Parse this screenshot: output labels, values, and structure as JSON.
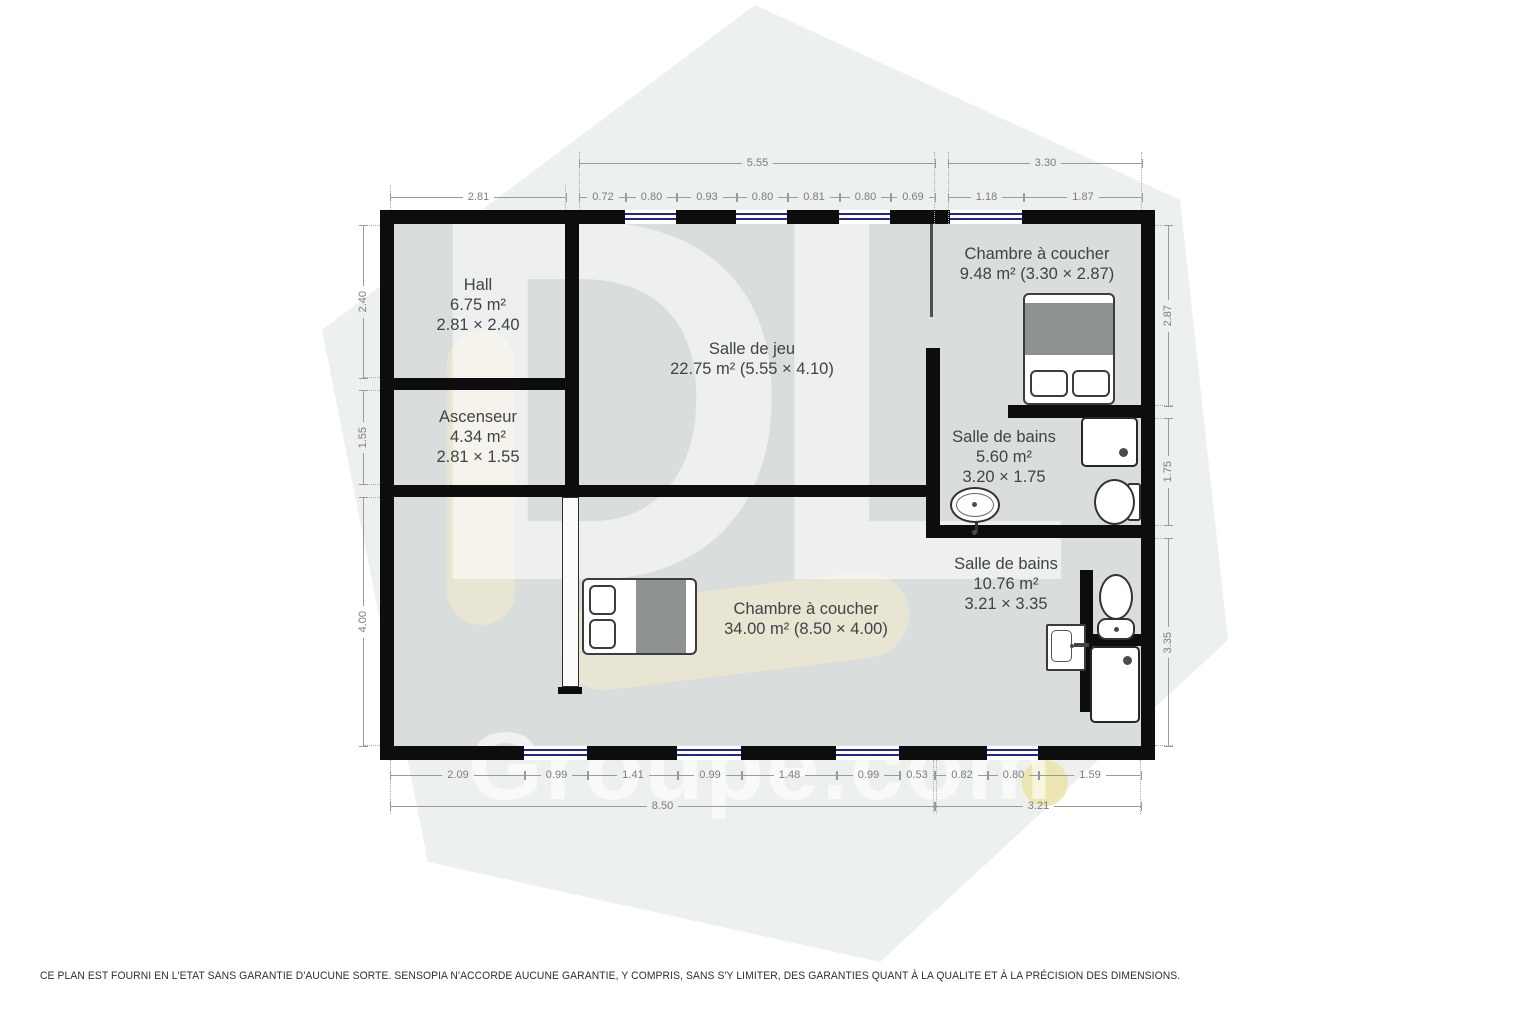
{
  "watermark": {
    "logo": "DL",
    "brand": "Groupe.com"
  },
  "palette": {
    "wall": "#0d0d0d",
    "floor": "#d9dddc",
    "hexagon": "#edf1ed",
    "window_glass": "#24249a",
    "dim_line": "#9a9a9a",
    "dim_text": "#7c7c7c",
    "room_text": "#3e4347",
    "watermark_accent": "#efeacd"
  },
  "rooms": {
    "hall": {
      "name": "Hall",
      "area": "6.75 m²",
      "size": "2.81 × 2.40"
    },
    "ascenseur": {
      "name": "Ascenseur",
      "area": "4.34 m²",
      "size": "2.81 × 1.55"
    },
    "salle_de_jeu": {
      "name": "Salle de jeu",
      "details": "22.75 m² (5.55 × 4.10)"
    },
    "chambre_nord": {
      "name": "Chambre à coucher",
      "details": "9.48 m² (3.30 × 2.87)"
    },
    "sdb_nord": {
      "name": "Salle de bains",
      "area": "5.60 m²",
      "size": "3.20 × 1.75"
    },
    "sdb_sud": {
      "name": "Salle de bains",
      "area": "10.76 m²",
      "size": "3.21 × 3.35"
    },
    "chambre_sud": {
      "name": "Chambre à coucher",
      "details": "34.00 m² (8.50 × 4.00)"
    }
  },
  "dimensions": [
    {
      "label": "5.55",
      "orient": "h",
      "x": 579,
      "y": 163,
      "length": 355
    },
    {
      "label": "3.30",
      "orient": "h",
      "x": 948,
      "y": 163,
      "length": 193
    },
    {
      "label": "2.81",
      "orient": "h",
      "x": 390,
      "y": 197,
      "length": 175
    },
    {
      "label": "0.72",
      "orient": "h",
      "x": 579,
      "y": 197,
      "length": 46
    },
    {
      "label": "0.80",
      "orient": "h",
      "x": 625,
      "y": 197,
      "length": 51
    },
    {
      "label": "0.93",
      "orient": "h",
      "x": 676,
      "y": 197,
      "length": 60
    },
    {
      "label": "0.80",
      "orient": "h",
      "x": 736,
      "y": 197,
      "length": 51
    },
    {
      "label": "0.81",
      "orient": "h",
      "x": 787,
      "y": 197,
      "length": 52
    },
    {
      "label": "0.80",
      "orient": "h",
      "x": 839,
      "y": 197,
      "length": 51
    },
    {
      "label": "0.69",
      "orient": "h",
      "x": 890,
      "y": 197,
      "length": 44
    },
    {
      "label": "1.18",
      "orient": "h",
      "x": 948,
      "y": 197,
      "length": 75
    },
    {
      "label": "1.87",
      "orient": "h",
      "x": 1023,
      "y": 197,
      "length": 118
    },
    {
      "label": "2.40",
      "orient": "v",
      "x": 363,
      "y": 225,
      "length": 152
    },
    {
      "label": "1.55",
      "orient": "v",
      "x": 363,
      "y": 390,
      "length": 93
    },
    {
      "label": "4.00",
      "orient": "v",
      "x": 363,
      "y": 497,
      "length": 248
    },
    {
      "label": "2.87",
      "orient": "v",
      "x": 1168,
      "y": 225,
      "length": 180
    },
    {
      "label": "1.75",
      "orient": "v",
      "x": 1168,
      "y": 418,
      "length": 106
    },
    {
      "label": "3.35",
      "orient": "v",
      "x": 1168,
      "y": 538,
      "length": 207
    },
    {
      "label": "2.09",
      "orient": "h",
      "x": 390,
      "y": 775,
      "length": 134
    },
    {
      "label": "0.99",
      "orient": "h",
      "x": 524,
      "y": 775,
      "length": 63
    },
    {
      "label": "1.41",
      "orient": "h",
      "x": 587,
      "y": 775,
      "length": 90
    },
    {
      "label": "0.99",
      "orient": "h",
      "x": 677,
      "y": 775,
      "length": 64
    },
    {
      "label": "1.48",
      "orient": "h",
      "x": 741,
      "y": 775,
      "length": 95
    },
    {
      "label": "0.99",
      "orient": "h",
      "x": 836,
      "y": 775,
      "length": 63
    },
    {
      "label": "0.53",
      "orient": "h",
      "x": 899,
      "y": 775,
      "length": 34
    },
    {
      "label": "0.82",
      "orient": "h",
      "x": 935,
      "y": 775,
      "length": 52
    },
    {
      "label": "0.80",
      "orient": "h",
      "x": 987,
      "y": 775,
      "length": 51
    },
    {
      "label": "1.59",
      "orient": "h",
      "x": 1038,
      "y": 775,
      "length": 102
    },
    {
      "label": "8.50",
      "orient": "h",
      "x": 390,
      "y": 806,
      "length": 543
    },
    {
      "label": "3.21",
      "orient": "h",
      "x": 935,
      "y": 806,
      "length": 205
    }
  ],
  "disclaimer": "CE PLAN EST FOURNI EN L'ETAT SANS GARANTIE D'AUCUNE SORTE. SENSOPIA N'ACCORDE AUCUNE GARANTIE, Y COMPRIS, SANS S'Y LIMITER, DES GARANTIES QUANT À LA QUALITE ET À LA PRÉCISION DES DIMENSIONS."
}
